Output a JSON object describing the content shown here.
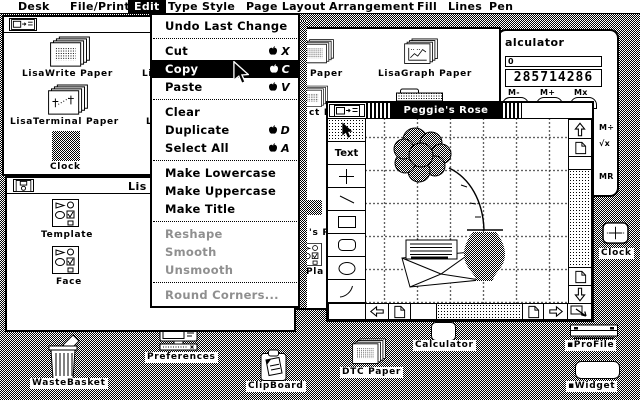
{
  "menu_bar": {
    "items": [
      "Desk",
      "File/Print",
      "Edit",
      "Type Style",
      "Page Layout",
      "Arrangement",
      "Fill",
      "Lines",
      "Pen"
    ]
  },
  "edit_menu": {
    "items": [
      {
        "label": "Undo Last Change",
        "shortcut": ""
      },
      {
        "label": "Cut",
        "shortcut": "X"
      },
      {
        "label": "Copy",
        "shortcut": "C"
      },
      {
        "label": "Paste",
        "shortcut": "V"
      },
      {
        "label": "Clear",
        "shortcut": ""
      },
      {
        "label": "Duplicate",
        "shortcut": "D"
      },
      {
        "label": "Select All",
        "shortcut": "A"
      },
      {
        "label": "Make Lowercase",
        "shortcut": ""
      },
      {
        "label": "Make Uppercase",
        "shortcut": ""
      },
      {
        "label": "Make Title",
        "shortcut": ""
      },
      {
        "label": "Reshape",
        "shortcut": ""
      },
      {
        "label": "Smooth",
        "shortcut": ""
      },
      {
        "label": "Unsmooth",
        "shortcut": ""
      },
      {
        "label": "Round Corners...",
        "shortcut": ""
      }
    ]
  },
  "stationery_window": {
    "icons": {
      "lisawrite": "LisaWrite Paper",
      "lisaterminal": "LisaTerminal Paper",
      "clock": "Clock",
      "fragment_row1": "Li",
      "fragment_row2": "L"
    }
  },
  "middle_window": {
    "icons": {
      "row1_fragment": "Paper",
      "lisagraph": "LisaGraph Paper",
      "row2_fragment": "ct P",
      "row3_fragment": "'s R",
      "row4_fragment": "Pla"
    }
  },
  "disk_window": {
    "title_fragment": "Lis",
    "icons": {
      "template": "Template",
      "face": "Face"
    }
  },
  "draw_window": {
    "title": "Peggie's Rose",
    "text_tool": "Text"
  },
  "calculator_window": {
    "title_fragment": "alculator",
    "memory_display": "0",
    "main_display": "285714286",
    "keys": {
      "m_minus": "M-",
      "m_plus": "M+",
      "m_times": "Mx",
      "m_divide": "M÷",
      "sqrt": "√x",
      "m_recall": "MR"
    }
  },
  "desktop_icons": {
    "wastebasket": "WasteBasket",
    "preferences": "Preferences",
    "clipboard": "ClipBoard",
    "dtc_paper": "DTC Paper",
    "calculator": "Calculator",
    "clock": "Clock",
    "profile": "▪ProFile",
    "widget": "▪Widget"
  },
  "colors": {
    "ink": "#000000",
    "paper": "#ffffff",
    "disabled_text": "#8f8f8f"
  }
}
